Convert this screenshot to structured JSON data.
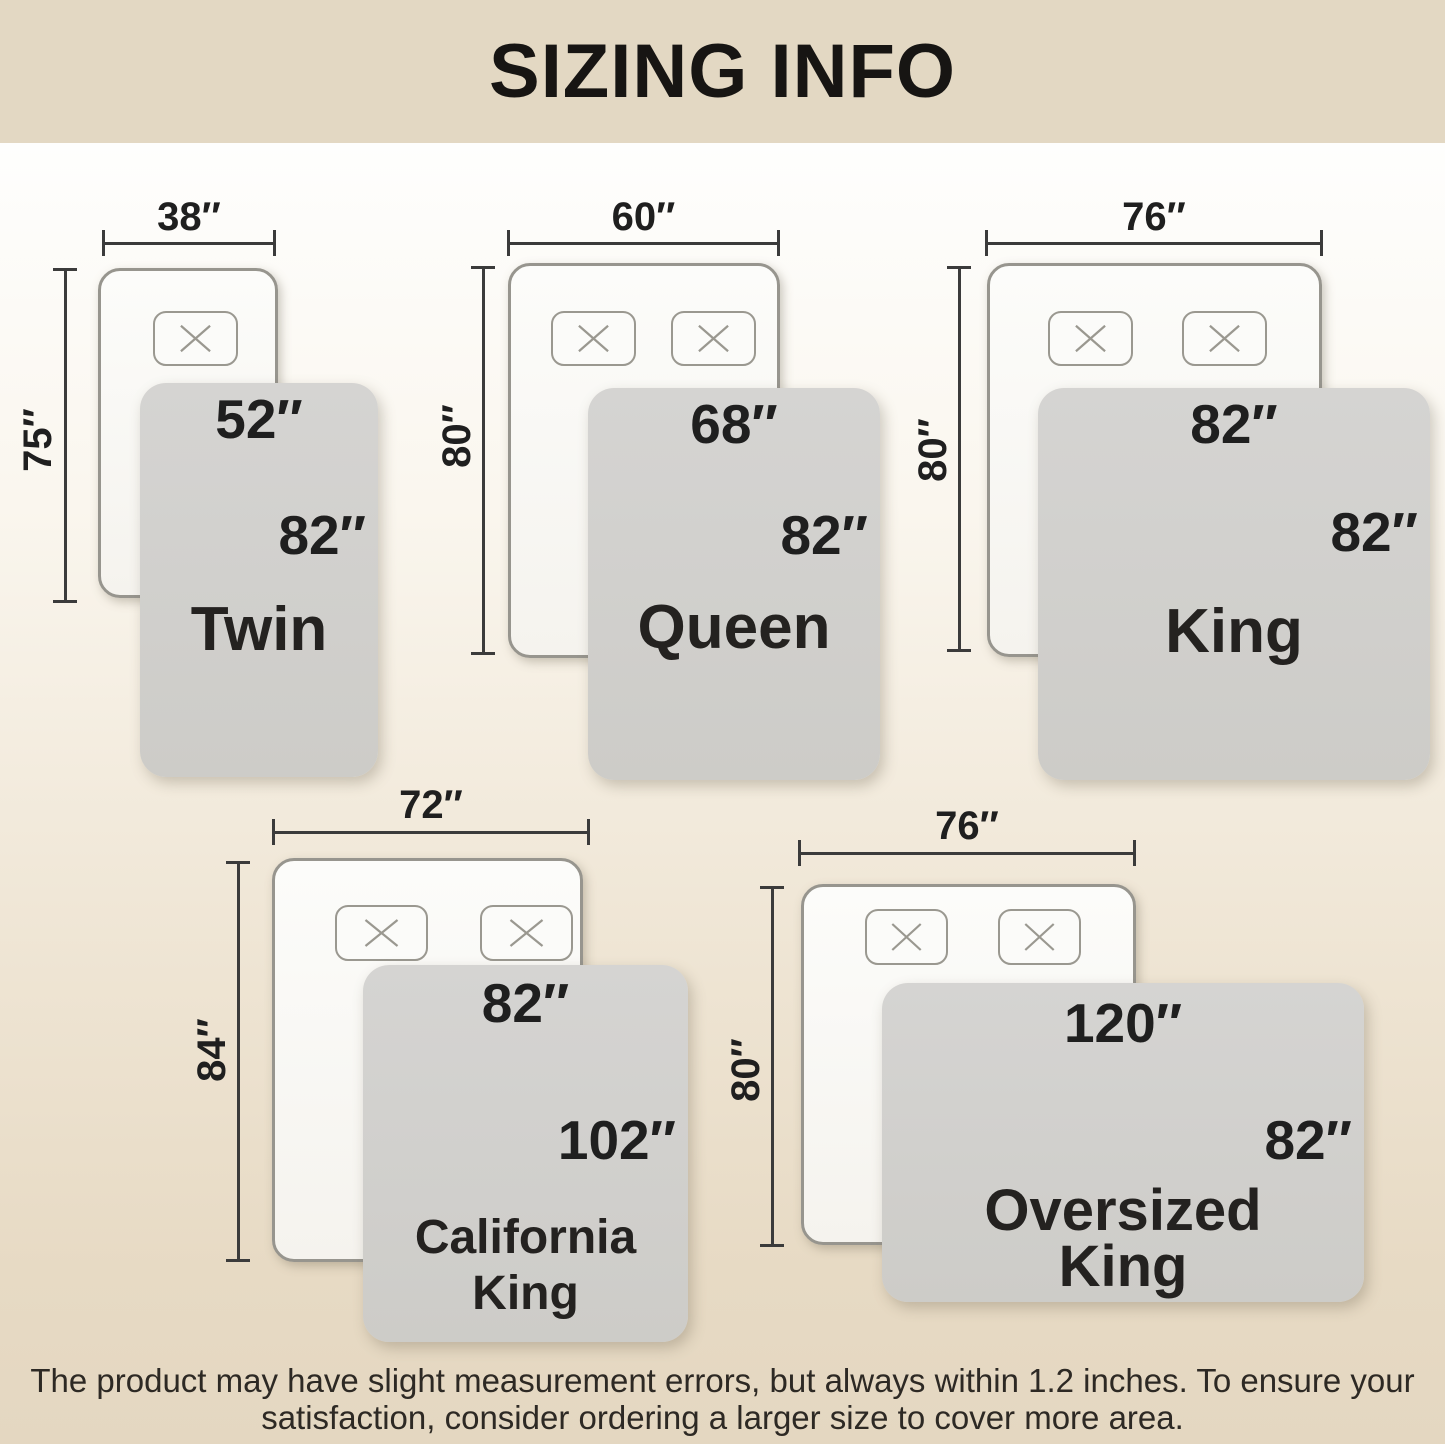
{
  "header": {
    "title": "SIZING INFO"
  },
  "sizes": [
    {
      "name": "Twin",
      "bed_width": "38″",
      "bed_length": "75″",
      "blanket_width": "52″",
      "blanket_length": "82″"
    },
    {
      "name": "Queen",
      "bed_width": "60″",
      "bed_length": "80″",
      "blanket_width": "68″",
      "blanket_length": "82″"
    },
    {
      "name": "King",
      "bed_width": "76″",
      "bed_length": "80″",
      "blanket_width": "82″",
      "blanket_length": "82″"
    },
    {
      "name": "California\nKing",
      "bed_width": "72″",
      "bed_length": "84″",
      "blanket_width": "82″",
      "blanket_length": "102″"
    },
    {
      "name": "Oversized\nKing",
      "bed_width": "76″",
      "bed_length": "80″",
      "blanket_width": "120″",
      "blanket_length": "82″"
    }
  ],
  "footer": {
    "line1": "The product may have slight measurement errors, but always within 1.2 inches. To ensure your",
    "line2": "satisfaction, consider ordering a larger size to cover more area."
  },
  "colors": {
    "header_bg": "#e3d8c3",
    "body_gradient_top": "#fefefd",
    "body_gradient_bottom": "#e4d7c1",
    "bed_fill": "#fbfbf9",
    "bed_border": "#97958e",
    "blanket_fill": "#d2d1ce",
    "dimension_line": "#3b3b3b",
    "text": "#1f1f1f"
  }
}
